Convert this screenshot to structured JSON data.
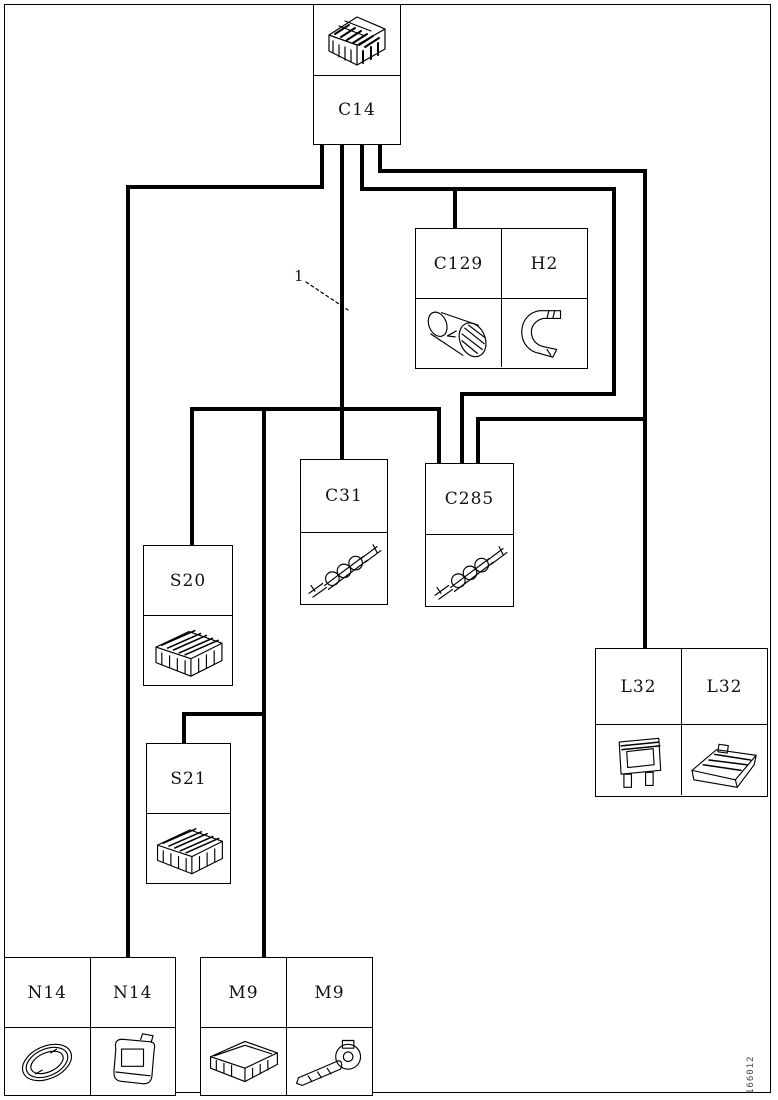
{
  "figure": {
    "callout_label": "1",
    "figure_id": "166012"
  },
  "labels": {
    "c14": "C14",
    "c129": "C129",
    "h2": "H2",
    "c31": "C31",
    "c285": "C285",
    "s20": "S20",
    "s21": "S21",
    "l32_left": "L32",
    "l32_right": "L32",
    "n14_left": "N14",
    "n14_right": "N14",
    "m9_left": "M9",
    "m9_right": "M9"
  },
  "illustrations": {
    "c14": "multi-pin-connector-block",
    "c129": "horn-cylinder",
    "h2": "mounting-bracket",
    "c31": "twisted-wire-splice",
    "c285": "twisted-wire-splice",
    "s20": "fuse-relay-box",
    "s21": "fuse-relay-box",
    "l32_left": "lamp-housing-front",
    "l32_right": "lamp-housing-side",
    "n14_left": "oval-ring",
    "n14_right": "horn-unit",
    "m9_left": "control-module",
    "m9_right": "lever-arm-unit"
  },
  "colors": {
    "line": "#000000",
    "background": "#ffffff"
  }
}
